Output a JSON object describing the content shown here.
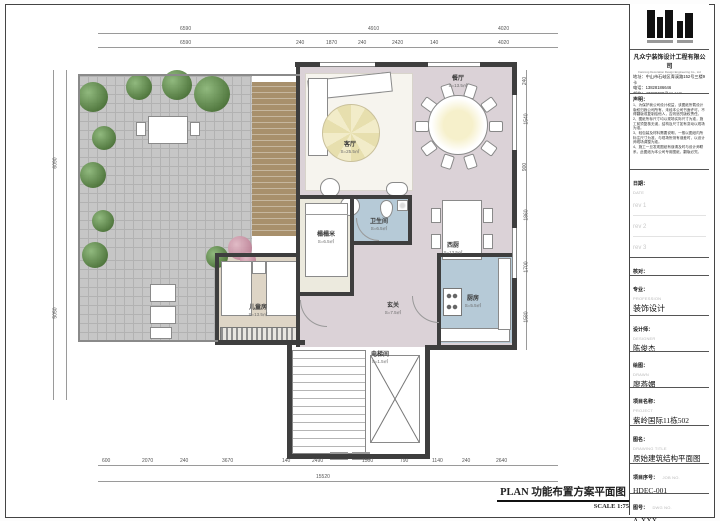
{
  "footer": {
    "title": "PLAN  功能布置方案平面图",
    "scale": "SCALE 1:75"
  },
  "titleblock": {
    "company": "凡众宁装饰设计工程有限公司",
    "company_en": "Fanzong Decoration Design Engineering Co., Ltd",
    "address": "地址：中山市石岐区青溪路152号三楼9卡",
    "phone": "电话：13828186646",
    "email": "邮箱：43380730@qq.com",
    "notes_title": "声明：",
    "notes": {
      "n1": "1、为保护我公司设计权益，该图纸所载设计版权归我公司所有，未经本公司书面许可，不得翻版或复制给他人，否则追究版权责任。",
      "n2": "2、图纸所标尺寸均以现场实际尺寸为准，施工前须复核无误，结构及尺寸如有变动以现场为准。",
      "n3": "3、轻包装及材料需要说明，一般以图纸内所标注尺寸为准，与现场所测有误差时，以设计师现场调整为准。",
      "n4": "4、施工一旦发现图纸有误请及时与设计师联系，此图纸为本公司专用图纸，翻版必究。"
    },
    "date_zh": "日期：",
    "date_en": "DATE",
    "rev1": "rev 1",
    "rev2": "rev 2",
    "rev3": "rev 3",
    "approved_zh": "核对：",
    "approved_en": "APPROVED",
    "profession_zh": "专业：",
    "profession_en": "PROFESSION",
    "profession_val": "装饰设计",
    "designer_zh": "设计师：",
    "designer_en": "DESIGNER",
    "designer_val": "陈俊杰",
    "drawn_zh": "绘图：",
    "drawn_en": "DRAWN",
    "drawn_val": "廖燕媚",
    "project_zh": "项目名称：",
    "project_en": "PROJECT",
    "project_val": "紫岭国际11栋502",
    "dwgtitle_zh": "图名：",
    "dwgtitle_en": "DRAWING TITLE",
    "dwgtitle_val": "原始建筑结构平面图",
    "jobno_zh": "项目序号：",
    "jobno_en": "JOB NO.",
    "jobno_val": "HDEC-001",
    "dwgno_zh": "图号：",
    "dwgno_en": "DWG NO.",
    "dwgno_val": "A-XXX"
  },
  "rooms": {
    "living": {
      "name": "客厅",
      "area": "S=25.5㎡"
    },
    "dining": {
      "name": "餐厅",
      "area": "S=13.5㎡"
    },
    "west_kitchen": {
      "name": "西厨",
      "area": "S=13.5㎡"
    },
    "kitchen": {
      "name": "厨房",
      "area": "S=5.5㎡"
    },
    "bath": {
      "name": "卫生间",
      "area": "S=6.5㎡"
    },
    "tatami": {
      "name": "榻榻米",
      "area": "S=6.5㎡"
    },
    "twin": {
      "name": "儿童房",
      "area": "S=13.5㎡"
    },
    "entry": {
      "name": "玄关",
      "area": "S=7.5㎡"
    },
    "elevator": {
      "name": "电梯间",
      "area": "S=1.5㎡"
    }
  },
  "dims": {
    "top": [
      "6590",
      "4910",
      "4020"
    ],
    "top_sub": [
      "6590",
      "240",
      "1870",
      "240",
      "2420",
      "140",
      "4020"
    ],
    "bottom": [
      "600",
      "2070",
      "240",
      "3670",
      "140",
      "2490",
      "1500",
      "790",
      "1140",
      "240",
      "2640"
    ],
    "bottom_total": "15520",
    "left": [
      "6090",
      "5050"
    ],
    "right": [
      "240",
      "1540",
      "900",
      "1860",
      "1700",
      "1580"
    ]
  }
}
